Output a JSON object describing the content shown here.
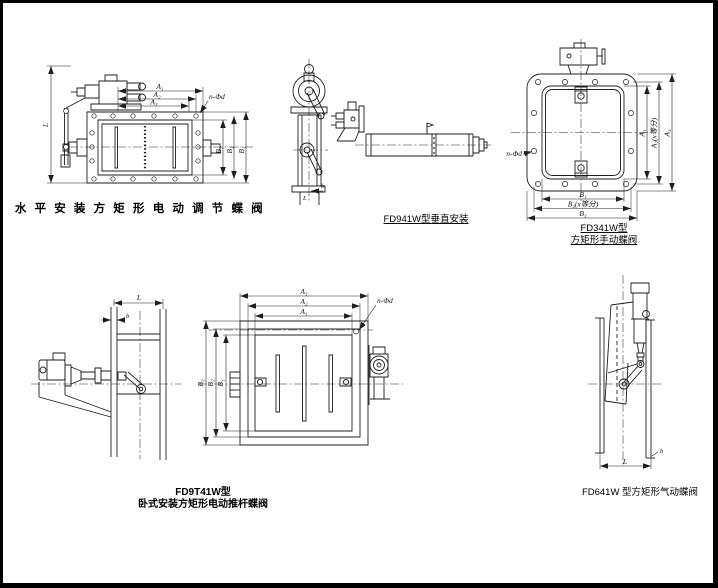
{
  "page": {
    "background": "#ffffff",
    "line_color": "#1f1f1f"
  },
  "captions": {
    "horizontal_electric": "水 平 安 装 方 矩 形 电 动 调 节 蝶 阀",
    "vertical_install": "FD941W型垂直安装",
    "manual_line1": "FD341W型",
    "manual_line2": "方矩形手动蝶阀",
    "pushrod_line1": "FD9T41W型",
    "pushrod_line2": "卧式安装方矩形电动推杆蝶阀",
    "pneumatic": "FD641W 型方矩形气动蝶阀"
  },
  "dim_labels": {
    "a1": "A₁",
    "a2": "A₂",
    "a3": "A₃",
    "b1": "B₁",
    "b2": "B₂",
    "b3": "B₃",
    "a2_div": "A₂(x等分)",
    "b2_div": "B₂(x等分)",
    "bolt_spec": "n-Φd",
    "length": "L",
    "width_b": "b"
  }
}
